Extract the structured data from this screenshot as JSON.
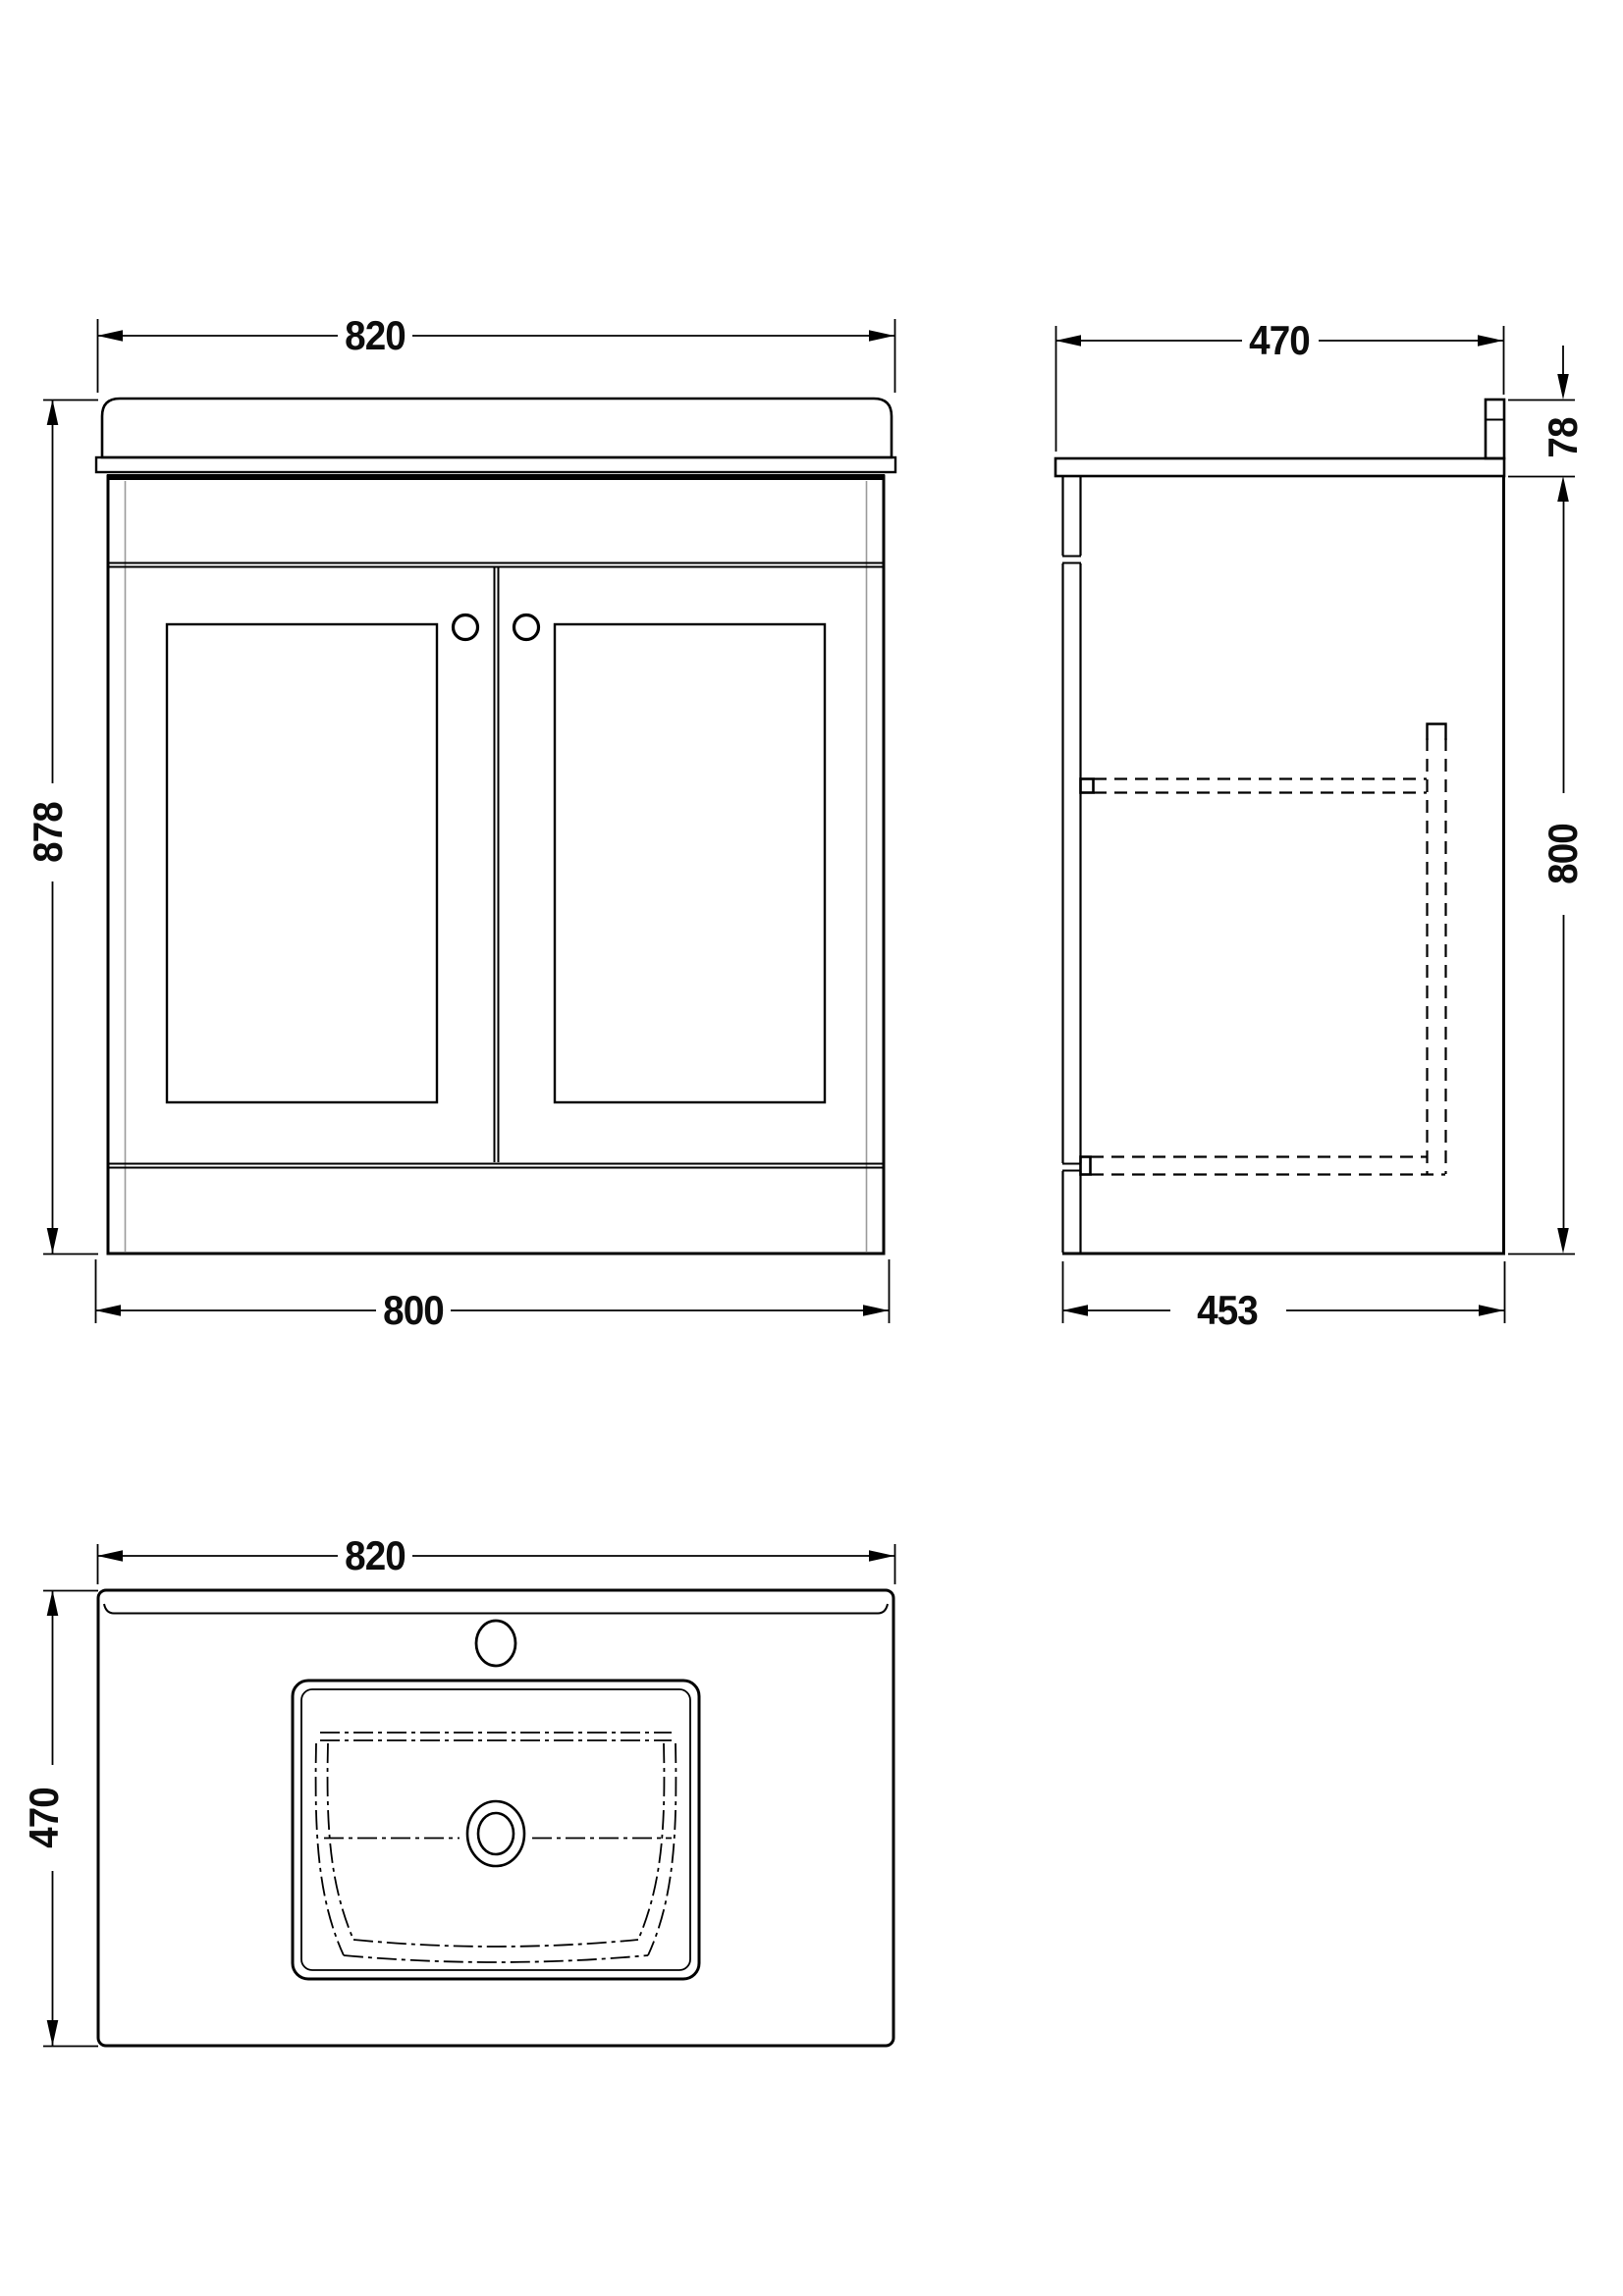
{
  "style": {
    "line_color": "#000000",
    "dim_color": "#0d0d0d",
    "hidden_line_color": "#000000",
    "carcass_grey": "#9b9b9b",
    "background": "#ffffff"
  },
  "views": {
    "front": {
      "dims": {
        "top_width": "820",
        "height": "878",
        "bottom_width": "800"
      }
    },
    "side": {
      "dims": {
        "top_depth": "470",
        "worktop_height": "78",
        "cabinet_height": "800",
        "bottom_depth": "453"
      }
    },
    "plan": {
      "dims": {
        "width": "820",
        "depth": "470"
      }
    }
  }
}
